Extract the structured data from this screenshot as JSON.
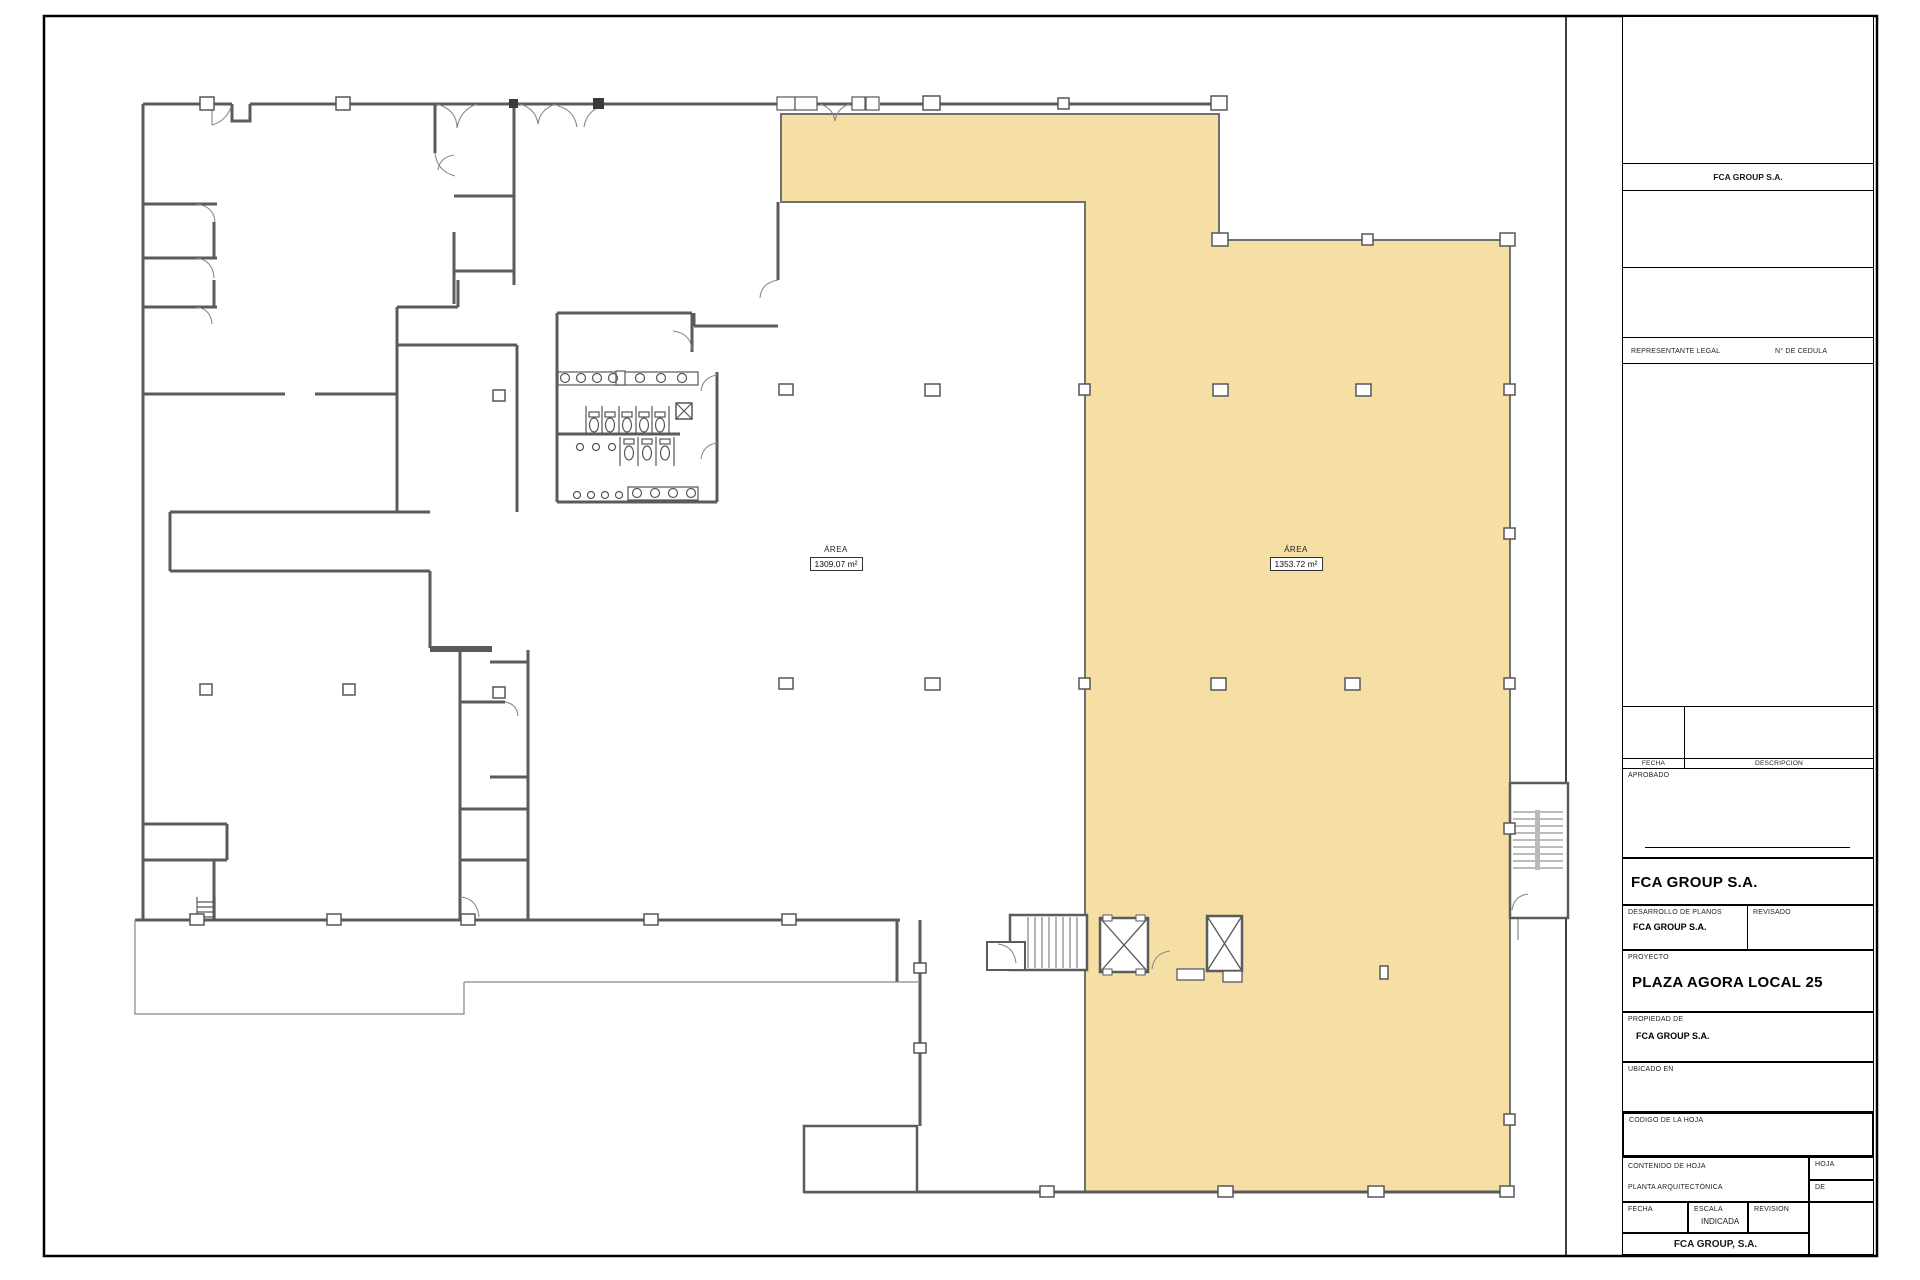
{
  "colors": {
    "highlight": "#F6DFA4",
    "wall": "#5a5b5d",
    "thin_line": "#85878a",
    "border": "#000000"
  },
  "plan": {
    "area_labels": [
      {
        "title": "ÁREA",
        "value": "1309.07 m²"
      },
      {
        "title": "ÁREA",
        "value": "1353.72 m²"
      }
    ]
  },
  "title_block": {
    "company_header": "FCA GROUP S.A.",
    "legal_rep_label": "REPRESENTANTE LEGAL",
    "cedula_label": "N° DE CEDULA",
    "fecha_label": "FECHA",
    "descripcion_label": "DESCRIPCION",
    "aprobado_label": "APROBADO",
    "director_line": "DIRECTOR DE OBRAS Y CONSTRUCCIONES MUNICIPALES",
    "company_name": "FCA GROUP S.A.",
    "desarrollo_label": "DESARROLLO DE PLANOS",
    "desarrollo_value": "FCA GROUP S.A.",
    "revisado_label": "REVISADO",
    "proyecto_label": "PROYECTO",
    "proyecto_value": "PLAZA AGORA LOCAL 25",
    "propiedad_label": "PROPIEDAD DE",
    "propiedad_value": "FCA GROUP S.A.",
    "ubicado_label": "UBICADO EN",
    "codigo_label": "CODIGO DE LA HOJA",
    "contenido_label": "CONTENIDO DE HOJA",
    "contenido_value": "PLANTA ARQUITECTÓNICA",
    "hoja_label": "HOJA",
    "de_label": "DE",
    "fecha2_label": "FECHA",
    "escala_label": "ESCALA",
    "escala_value": "INDICADA",
    "revision_label": "REVISION",
    "footer_company": "FCA GROUP, S.A."
  }
}
